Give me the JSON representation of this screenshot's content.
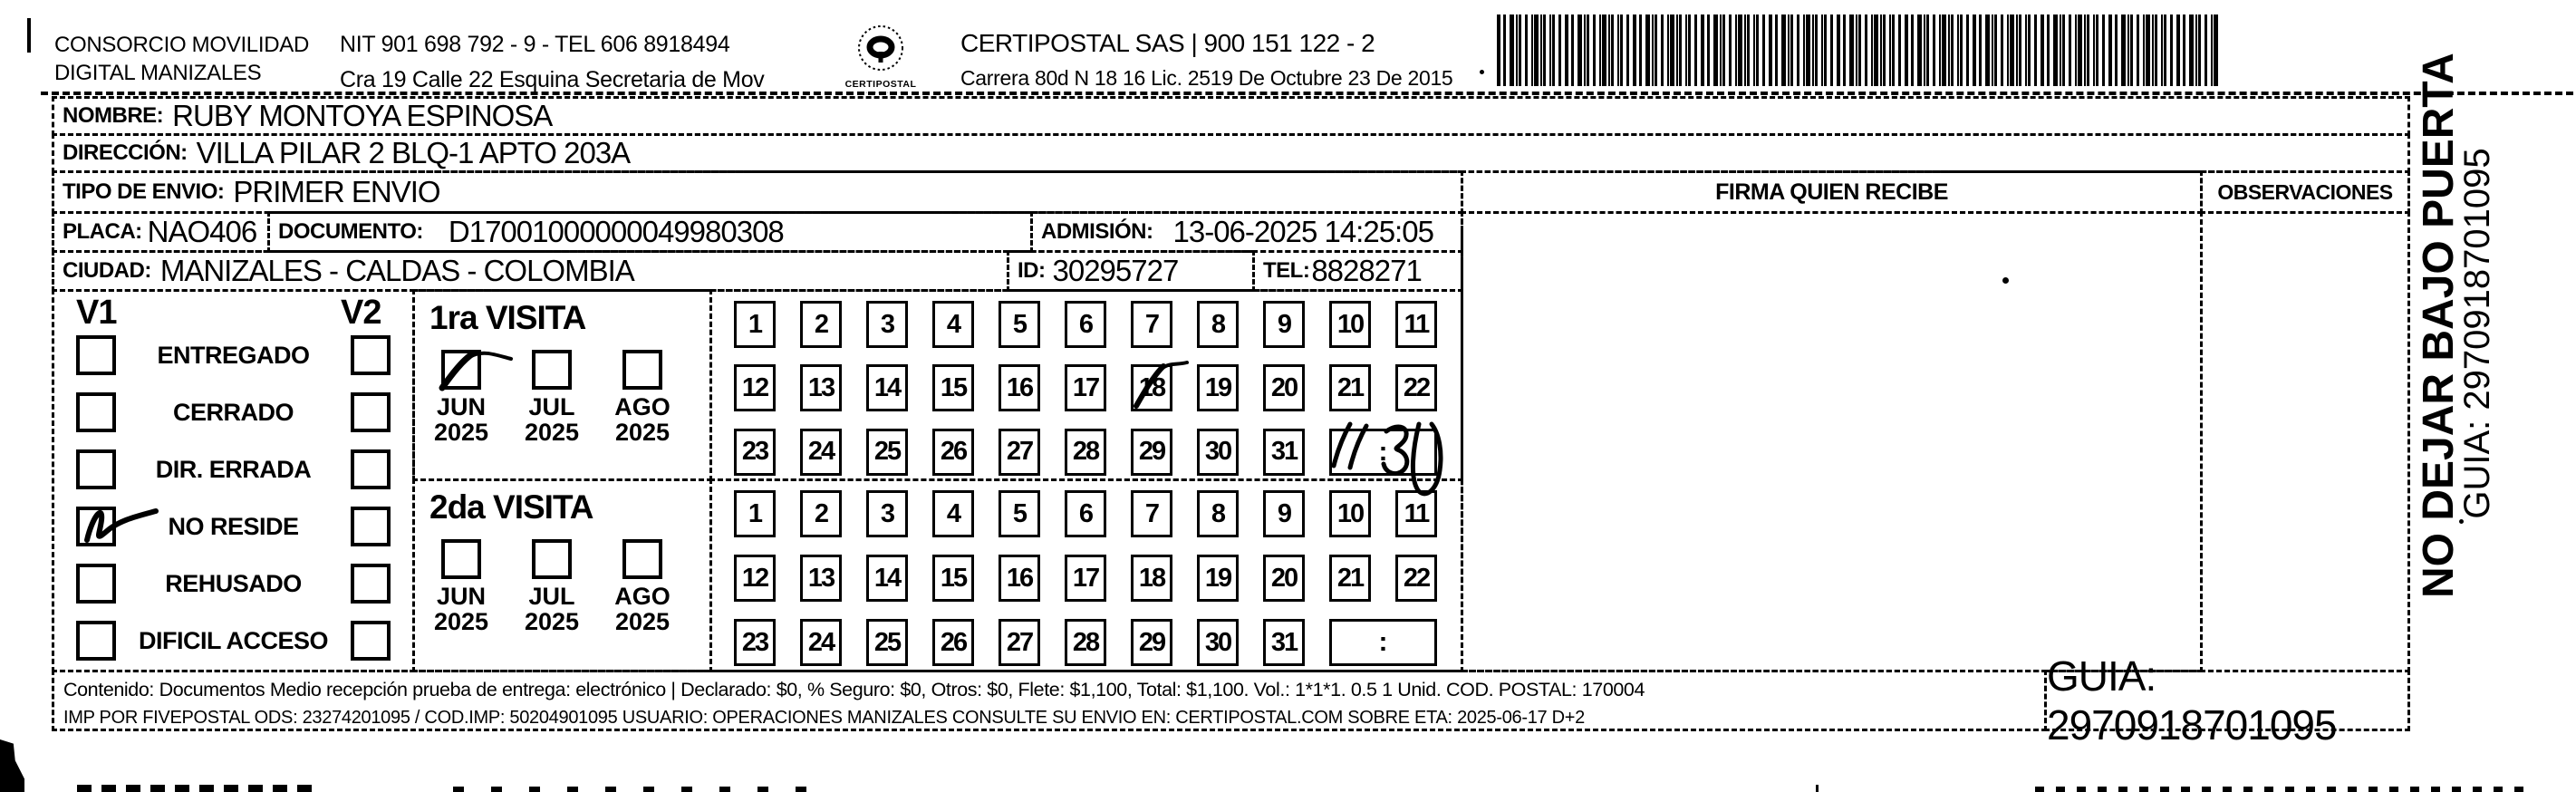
{
  "header": {
    "company_line1": "CONSORCIO MOVILIDAD",
    "company_line2": "DIGITAL MANIZALES",
    "nit_line": "NIT 901 698 792 - 9 - TEL 606 8918494",
    "address_line": "Cra 19 Calle 22 Esquina Secretaria de Mov",
    "logo_caption": "CERTIPOSTAL",
    "cert_line1": "CERTIPOSTAL SAS | 900 151 122 - 2",
    "cert_line2": "Carrera 80d N 18 16  Lic. 2519 De Octubre 23 De 2015"
  },
  "fields": {
    "nombre": {
      "label": "NOMBRE:",
      "value": "RUBY MONTOYA ESPINOSA"
    },
    "direccion": {
      "label": "DIRECCIÓN:",
      "value": "VILLA PILAR 2 BLQ-1 APTO 203A"
    },
    "tipo_envio": {
      "label": "TIPO DE ENVIO:",
      "value": "PRIMER ENVIO"
    },
    "placa": {
      "label": "PLACA:",
      "value": "NAO406"
    },
    "documento": {
      "label": "DOCUMENTO:",
      "value": "D17001000000049980308"
    },
    "admision": {
      "label": "ADMISIÓN:",
      "value": "13-06-2025 14:25:05"
    },
    "ciudad": {
      "label": "CIUDAD:",
      "value": "MANIZALES - CALDAS - COLOMBIA"
    },
    "id": {
      "label": "ID:",
      "value": "30295727"
    },
    "tel": {
      "label": "TEL:",
      "value": "8828271"
    }
  },
  "visits": {
    "v1_header": "V1",
    "v2_header": "V2",
    "statuses": [
      "ENTREGADO",
      "CERRADO",
      "DIR. ERRADA",
      "NO RESIDE",
      "REHUSADO",
      "DIFICIL ACCESO"
    ],
    "visit1_title": "1ra VISITA",
    "visit2_title": "2da VISITA",
    "months": [
      "JUN",
      "JUL",
      "AGO"
    ],
    "year": "2025",
    "days": [
      1,
      2,
      3,
      4,
      5,
      6,
      7,
      8,
      9,
      10,
      11,
      12,
      13,
      14,
      15,
      16,
      17,
      18,
      19,
      20,
      21,
      22,
      23,
      24,
      25,
      26,
      27,
      28,
      29,
      30,
      31
    ],
    "time_placeholder": ":",
    "handwriting": {
      "v1_checked_status": "NO RESIDE",
      "visit1_month_checked": "JUN 2025",
      "visit1_day_marked": "18",
      "visit1_time_written": "11:30"
    }
  },
  "right_panel": {
    "firma_header": "FIRMA QUIEN RECIBE",
    "observaciones_header": "OBSERVACIONES"
  },
  "side": {
    "no_dejar": "NO DEJAR BAJO PUERTA",
    "guia": "GUIA: 2970918701095"
  },
  "footer": {
    "line1": "Contenido: Documentos Medio recepción prueba de entrega: electrónico | Declarado: $0, % Seguro: $0, Otros: $0, Flete: $1,100, Total: $1,100. Vol.: 1*1*1. 0.5  1 Unid. COD. POSTAL: 170004",
    "line2": "IMP POR FIVEPOSTAL ODS: 23274201095 / COD.IMP: 50204901095 USUARIO: OPERACIONES MANIZALES CONSULTE SU ENVIO EN: CERTIPOSTAL.COM SOBRE ETA: 2025-06-17 D+2",
    "guia_box": "GUIA: 2970918701095"
  },
  "barcode": {
    "value": "2970918701095"
  }
}
